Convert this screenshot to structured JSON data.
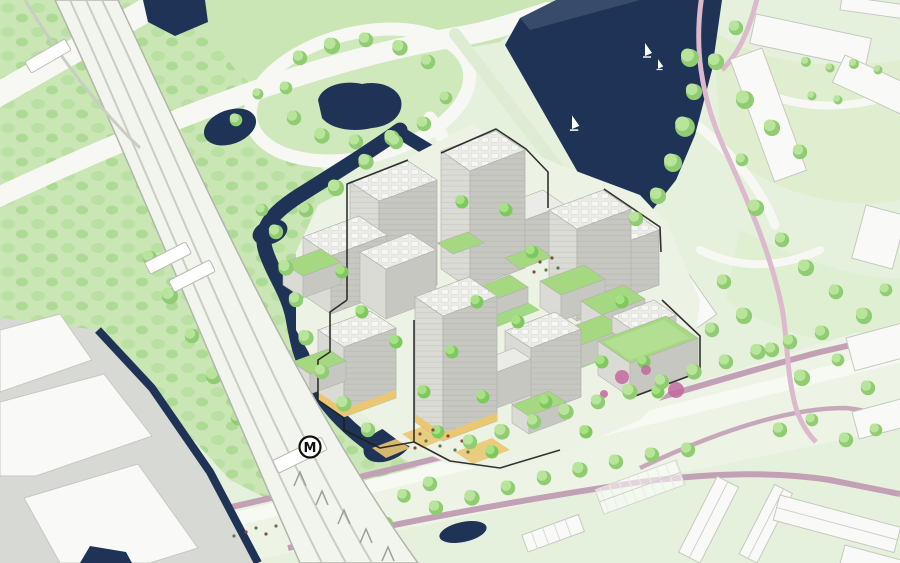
{
  "scene": {
    "type": "axonometric-masterplan-illustration",
    "metro_station_label": "M",
    "features": {
      "lake": "lake with sailboats",
      "metro": "elevated metro line with station",
      "development": "new building cluster with green roofs",
      "context": "existing white buildings and rowhouses"
    },
    "sailboat_count": 3
  },
  "palette": {
    "water": "#1e3356",
    "baseGreen": "#e6f1dd",
    "midGreen": "#c9e6b4",
    "moundGreen": "#cfe9bd",
    "lawnWash": "#d9ecc7",
    "bushA": "#b7dfa0",
    "bushB": "#a6d78d",
    "treeDark": "#8fcc72",
    "treeLight": "#b9e49c",
    "brightTree": "#7ec95d",
    "brightTreeLight": "#a8e184",
    "road": "#f7f8f3",
    "roadEdge": "#d8dcd0",
    "shoreRoad": "#dfecd4",
    "mauve": "#c2a0b6",
    "pinkPath": "#dcb9cd",
    "boulevard": "#edf3e5",
    "grayGround": "#d7d9d4",
    "slabWhite": "#f9faf7",
    "slabEdge": "#c6c8c1",
    "bldgTop": "#ebebe7",
    "bldgLeft": "#dbdbd6",
    "bldgRight": "#c7c7c2",
    "bldgLine": "#b2b2ac",
    "greenRoof": "#a5d880",
    "greenRoofLight": "#bfe6a0",
    "courtyard": "#9bd77a",
    "yellow": "#eac873",
    "outline": "#1d1d1d",
    "railLine": "#c9cdc2",
    "railEdge": "#b2b6aa",
    "trainWhite": "#ffffff",
    "people": "#8a4a38",
    "people2": "#5d7a4a",
    "flower": "#c2699f"
  }
}
